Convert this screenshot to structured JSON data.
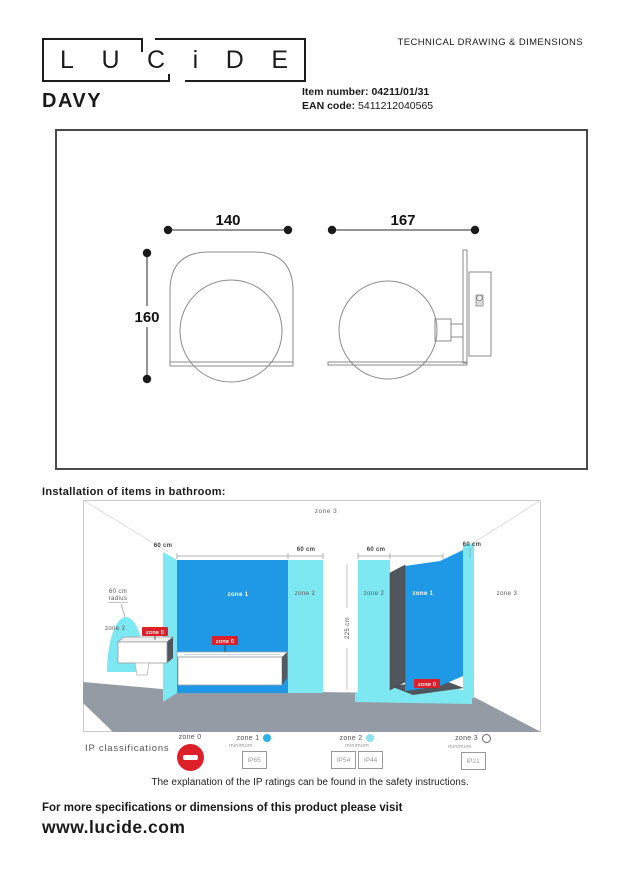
{
  "header": {
    "logo_letters": [
      "L",
      "U",
      "C",
      "i",
      "D",
      "E"
    ],
    "doc_type": "TECHNICAL DRAWING & DIMENSIONS",
    "product_name": "DAVY",
    "item_number_label": "Item number:",
    "item_number": "04211/01/31",
    "ean_label": "EAN code:",
    "ean": "5411212040565"
  },
  "technical_drawing": {
    "front_view": {
      "width_mm": "140",
      "height_mm": "160"
    },
    "side_view": {
      "depth_mm": "167"
    }
  },
  "bathroom_diagram": {
    "heading": "Installation of items in bathroom:",
    "zone_labels": {
      "zone0": "zone 0",
      "zone1": "zone 1",
      "zone2": "zone 2",
      "zone3": "zone 3"
    },
    "dimensions": {
      "sixty_cm": "60 cm",
      "room_height": "225 cm",
      "radius_line1": "60 cm",
      "radius_line2": "radius"
    }
  },
  "ip_legend": {
    "title": "IP classifications",
    "minimum_label": "minimum",
    "zones": [
      {
        "label": "zone 0",
        "ratings": []
      },
      {
        "label": "zone 1",
        "ratings": [
          "IP65"
        ]
      },
      {
        "label": "zone 2",
        "ratings": [
          "IP54",
          "IP44"
        ]
      },
      {
        "label": "zone 3",
        "ratings": [
          "IP21"
        ]
      }
    ],
    "note": "The explanation of the IP ratings can be found in the safety instructions."
  },
  "footer": {
    "line1": "For more specifications or dimensions of this product please visit",
    "website": "www.lucide.com"
  },
  "colors": {
    "zone1_blue": "#1f99e6",
    "zone2_cyan": "#7de7f2",
    "zone0_red": "#dc1f28",
    "floor_gray": "#949ba5",
    "panel_dark": "#50565c"
  }
}
